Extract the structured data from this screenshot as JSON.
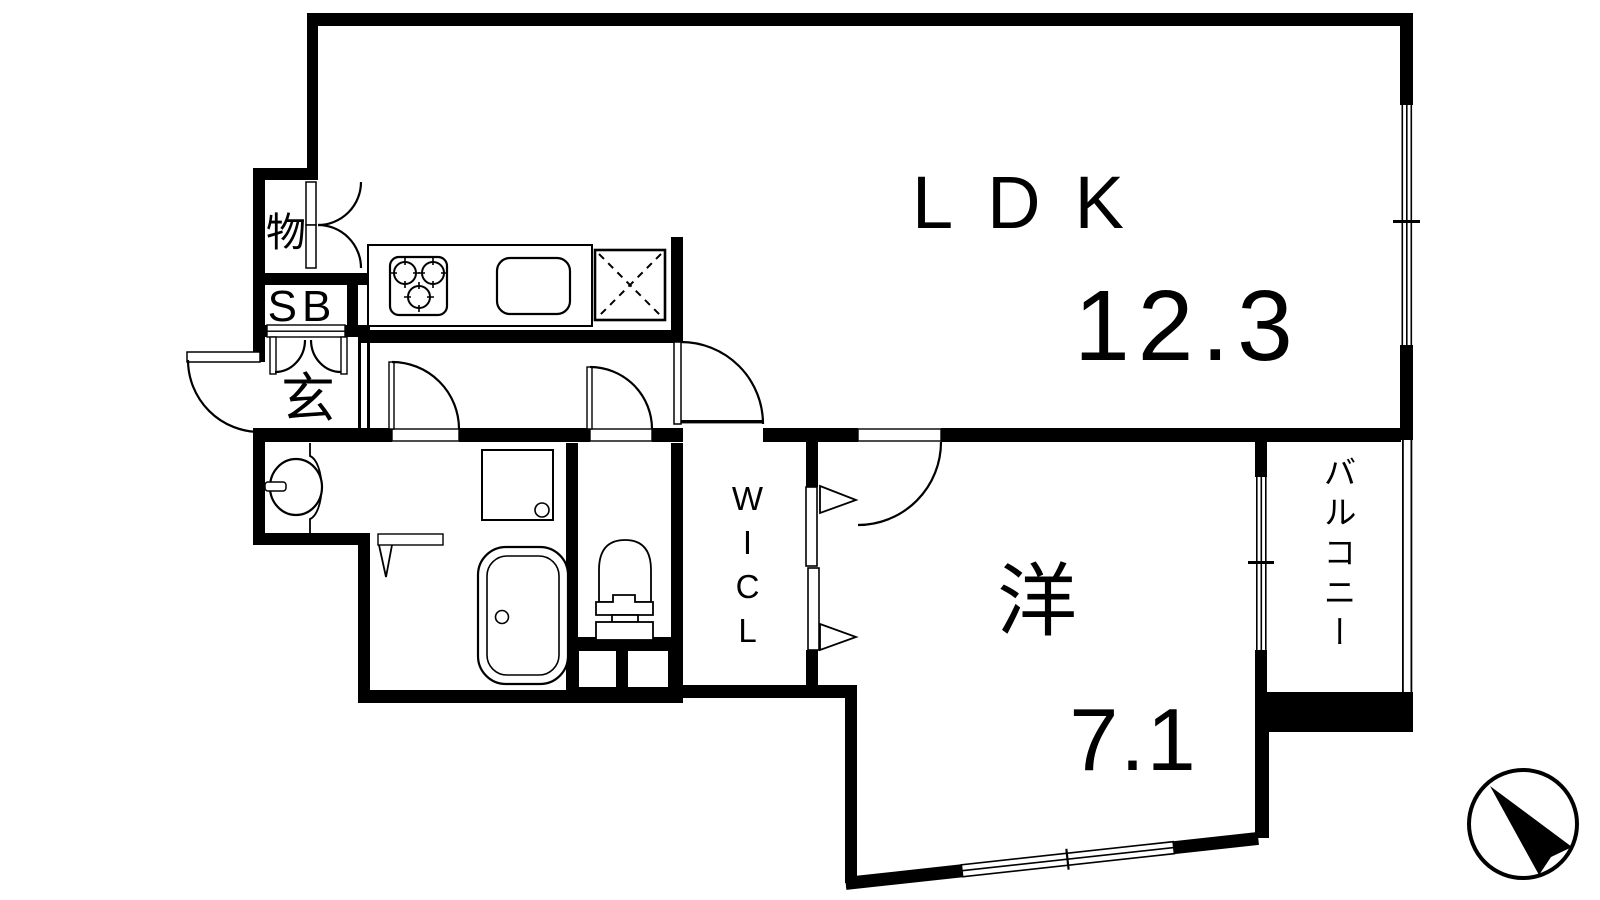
{
  "plan": {
    "title": "apartment-floor-plan-1ldk",
    "rooms": {
      "ldk": {
        "name": "LDK",
        "area": "12.3"
      },
      "western_room": {
        "name": "洋",
        "area": "7.1"
      },
      "balcony": {
        "name": "バルコニー"
      },
      "walk_in_closet": {
        "name": "WICL"
      },
      "entrance": {
        "name": "玄"
      },
      "storage": {
        "name": "物"
      },
      "shoe_box": {
        "name": "SB"
      }
    },
    "fixtures": [
      "stove-icon",
      "kitchen-sink-icon",
      "refrigerator-space-icon",
      "bathtub-icon",
      "toilet-icon",
      "washbasin-icon",
      "washer-pan-icon",
      "compass-north-icon"
    ],
    "colors": {
      "line": "#000000",
      "background": "#ffffff"
    }
  }
}
